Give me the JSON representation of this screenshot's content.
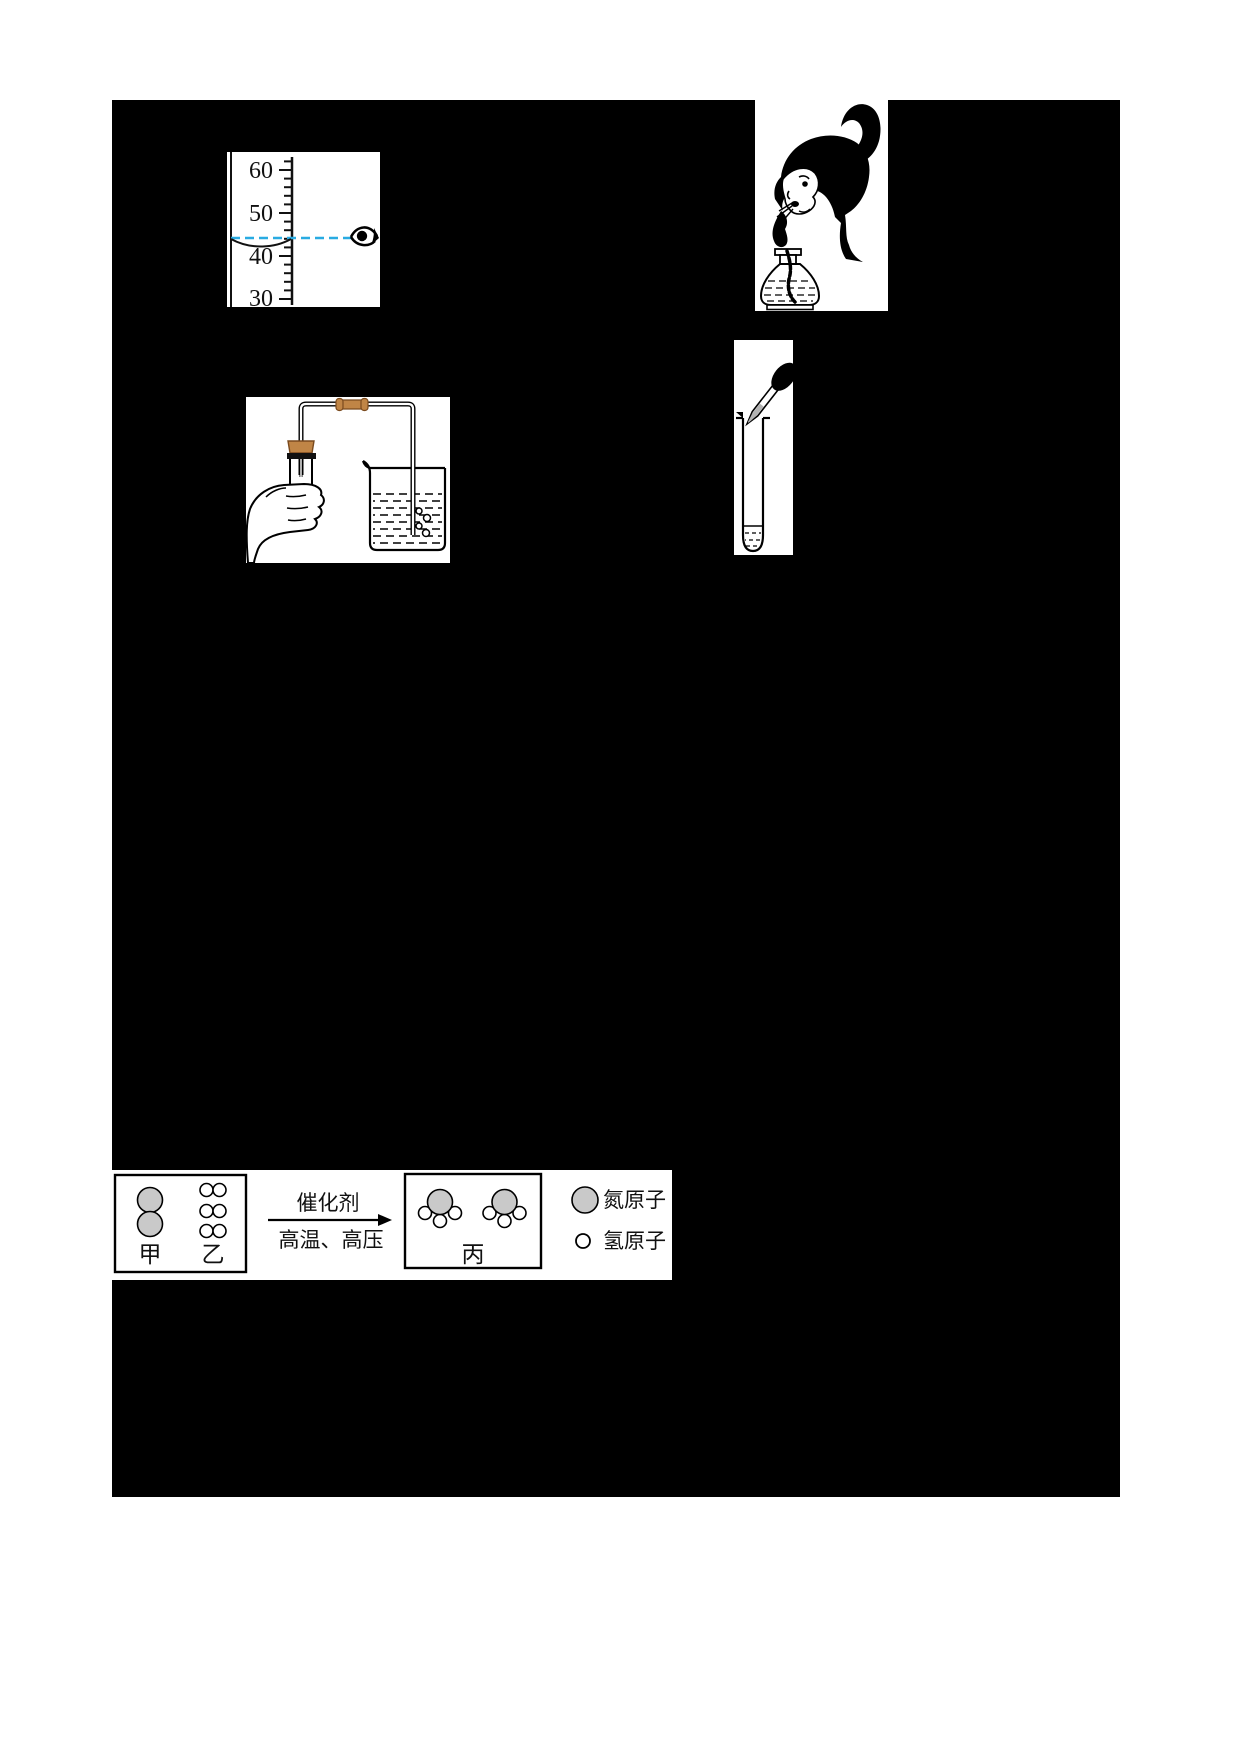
{
  "colors": {
    "page_bg": "#ffffff",
    "redaction_black": "#000000",
    "sight_line_blue": "#29abe2",
    "stopper_brown": "#c08546",
    "nitrogen_gray": "#c9c9c9",
    "dropper_liquid_gray": "#b3b3b3"
  },
  "cylinder_figure": {
    "ticks": [
      "60",
      "50",
      "40",
      "30"
    ]
  },
  "ammonia_figure": {
    "reactant1_label": "甲",
    "reactant2_label": "乙",
    "product_label": "丙",
    "arrow_top_label": "催化剂",
    "arrow_bottom_label": "高温、高压",
    "legend_nitrogen_label": "氮原子",
    "legend_hydrogen_label": "氢原子"
  }
}
